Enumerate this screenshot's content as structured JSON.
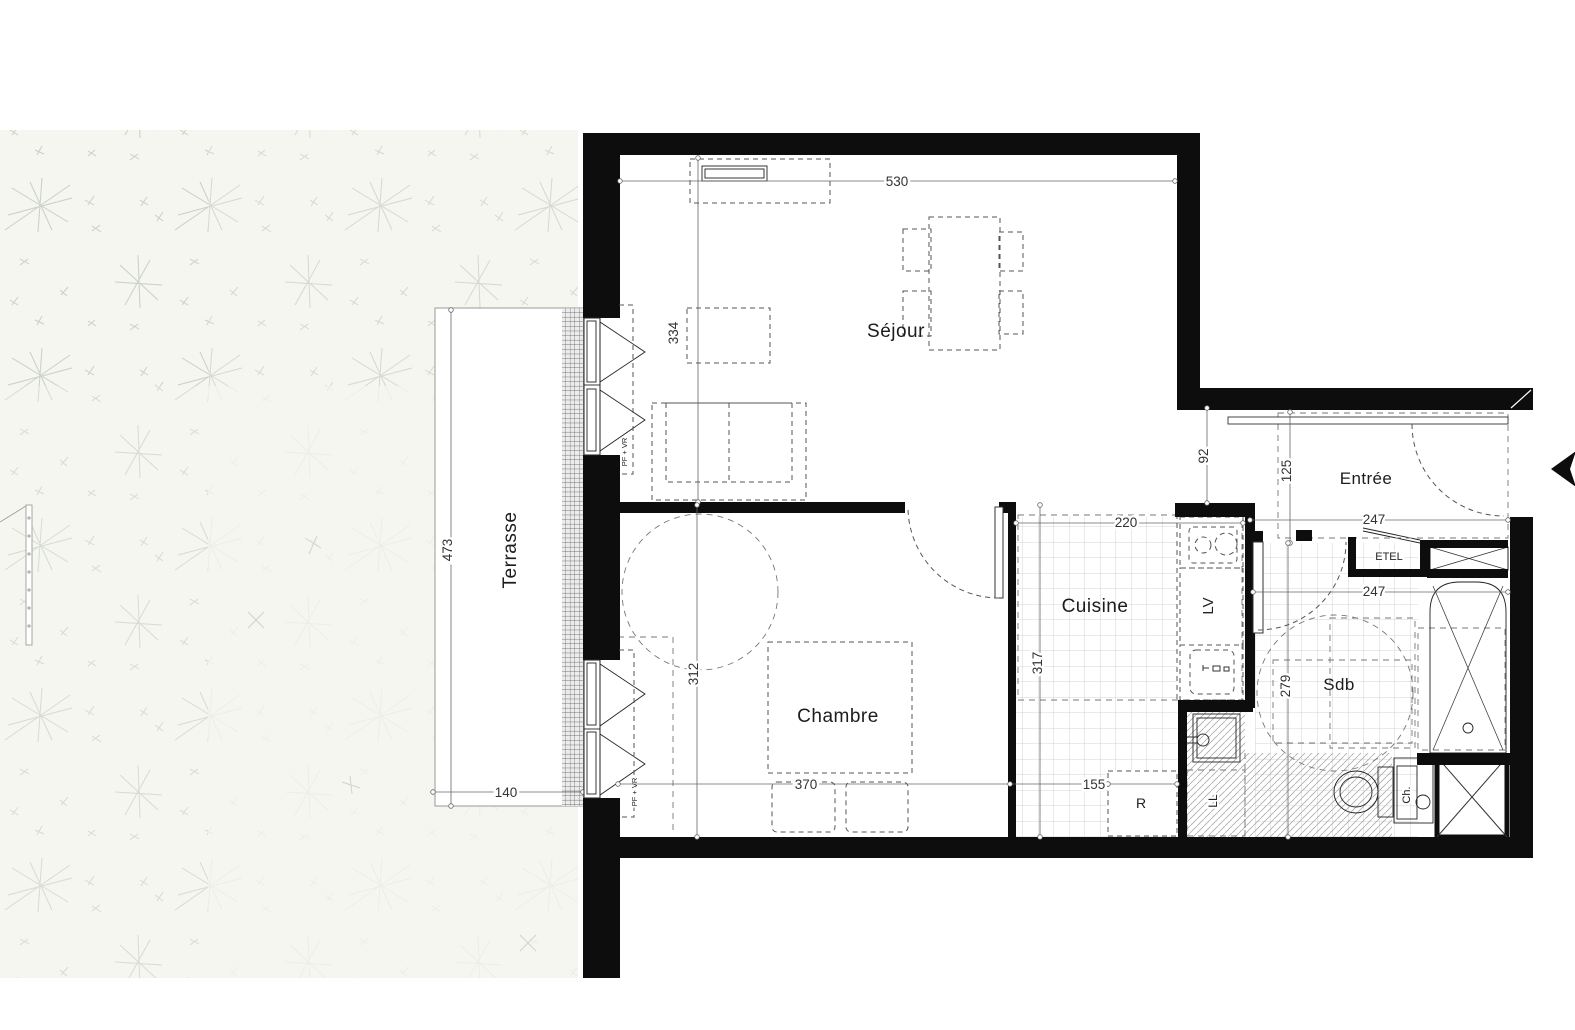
{
  "title": "Plan d'appartement T2",
  "rooms": {
    "sejour": "Séjour",
    "chambre": "Chambre",
    "cuisine": "Cuisine",
    "entree": "Entrée",
    "sdb": "Sdb",
    "terrasse": "Terrasse"
  },
  "equipment": {
    "lv": "LV",
    "refrigerator": "R",
    "ll": "LL",
    "ch": "Ch.",
    "etel": "ETEL",
    "window_label": "PF + VR"
  },
  "dimensions": {
    "sejour_w": "530",
    "sejour_h": "334",
    "passage_w": "92",
    "entree_d": "125",
    "entree_w": "247",
    "sdb_w": "247",
    "sdb_h": "279",
    "cuisine_w": "220",
    "cuisine_h": "317",
    "cuisine_w2": "155",
    "chambre_w": "370",
    "chambre_h": "312",
    "terrasse_h": "473",
    "terrasse_w": "140"
  },
  "colors": {
    "wall": "#0d0d0d",
    "garden_bg": "#f5f6f0",
    "dim_line": "#666666"
  }
}
